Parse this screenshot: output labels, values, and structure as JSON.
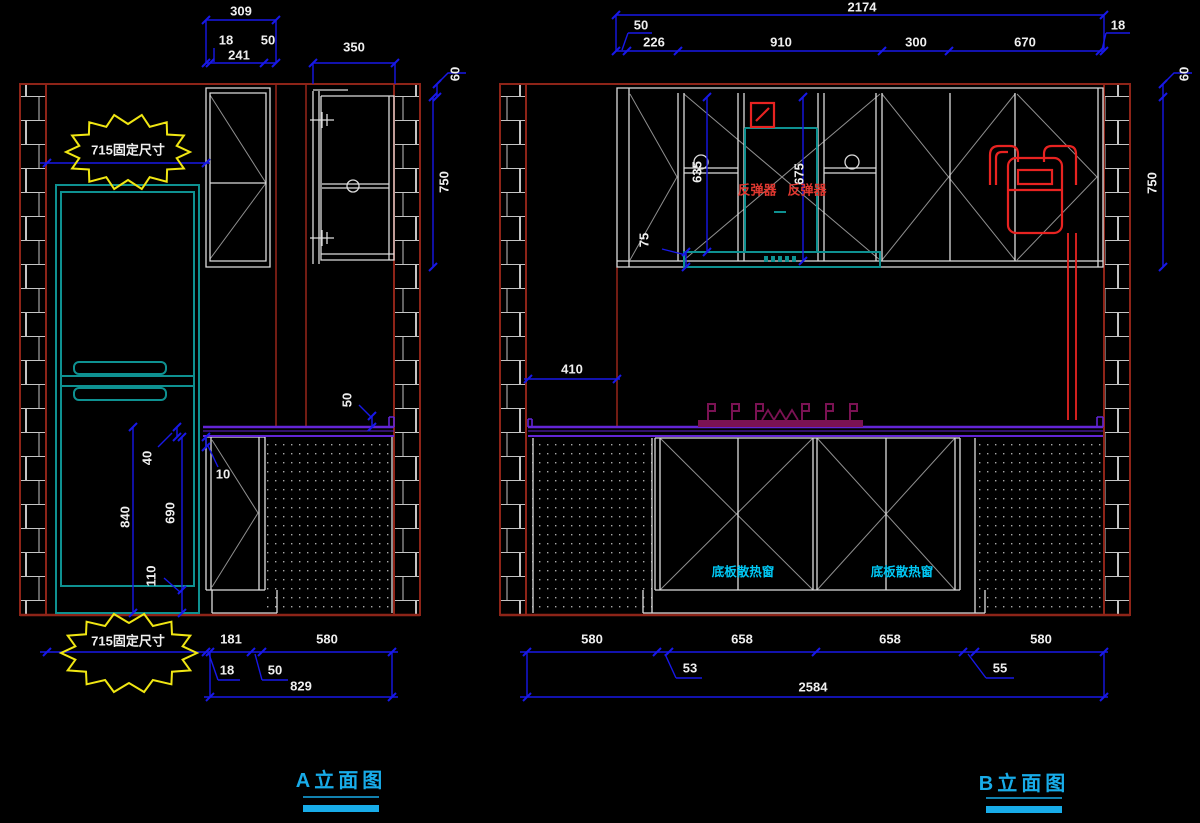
{
  "drawing": {
    "background": "#000000",
    "colors": {
      "dimension_blue": "#1818E8",
      "dimension_text": "#EFEFEF",
      "wall_red": "#8E2418",
      "brick_line": "#C4C4C4",
      "cabinet_white": "#DCDCDC",
      "door_swing_gray": "#8F8F8F",
      "fridge_teal": "#0E9191",
      "counter_purple": "#6325D5",
      "stove_magenta": "#7A1253",
      "appliance_red": "#E82321",
      "label_cyan": "#00C8F5",
      "cloud_yellow": "#F0E613"
    },
    "elevation_a": {
      "title": "A立面图",
      "fixed_note_top": "715固定尺寸",
      "fixed_note_bottom": "715固定尺寸",
      "dims_top": {
        "total": "309",
        "d18": "18",
        "d241": "241",
        "d50": "50",
        "d350": "350",
        "d60": "60",
        "d750": "750"
      },
      "dims_fridge": {
        "d840": "840",
        "d40": "40",
        "d690": "690",
        "d110": "110",
        "d10": "10",
        "d50_backsplash": "50"
      },
      "dims_bottom": {
        "d181": "181",
        "d580": "580",
        "d18": "18",
        "d50": "50",
        "total": "829"
      }
    },
    "elevation_b": {
      "title": "B立面图",
      "labels": {
        "rebound_left": "反弹器",
        "rebound_right": "反弹器",
        "vent_left": "底板散热窗",
        "vent_right": "底板散热窗"
      },
      "dims_top": {
        "total": "2174",
        "d50": "50",
        "d226": "226",
        "d910": "910",
        "d300": "300",
        "d670": "670",
        "d18": "18",
        "d60": "60",
        "d750": "750"
      },
      "dims_cabinet": {
        "d635": "635",
        "d675": "675",
        "d75": "75",
        "d410": "410"
      },
      "dims_bottom": {
        "d580_left": "580",
        "d53": "53",
        "d658_left": "658",
        "d658_right": "658",
        "d55": "55",
        "d580_right": "580",
        "total": "2584"
      }
    }
  }
}
